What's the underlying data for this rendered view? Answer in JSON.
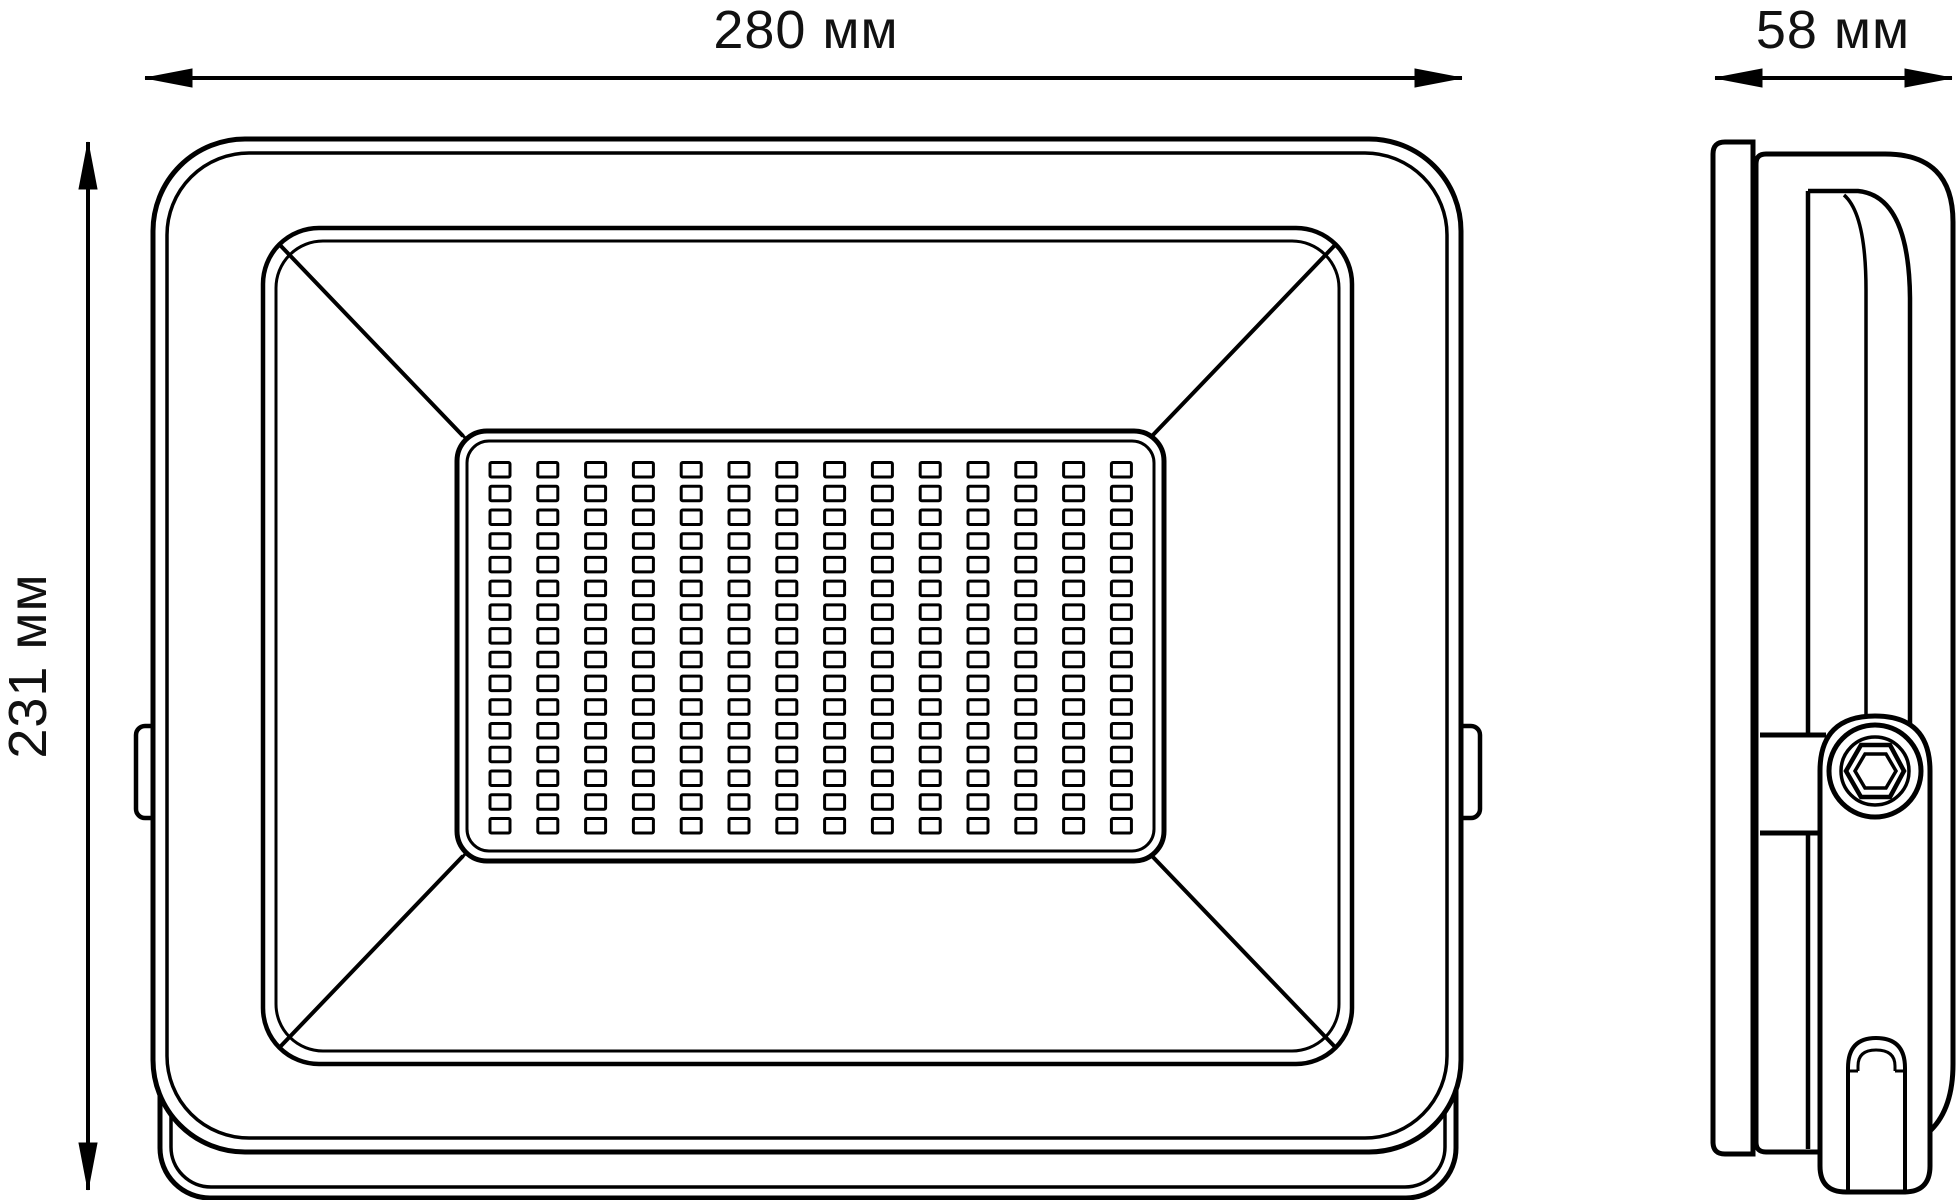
{
  "drawing": {
    "type": "technical-drawing-led-floodlight",
    "views": {
      "front_view": "front view of LED floodlight",
      "side_view": "side profile with mounting bracket"
    },
    "dimensions": {
      "width_label": "280 мм",
      "depth_label": "58 мм",
      "height_label": "231 мм"
    },
    "led_grid": {
      "rows": 16,
      "cols": 14
    },
    "colors": {
      "line": "#000000",
      "background": "#ffffff",
      "text": "#111111"
    }
  }
}
